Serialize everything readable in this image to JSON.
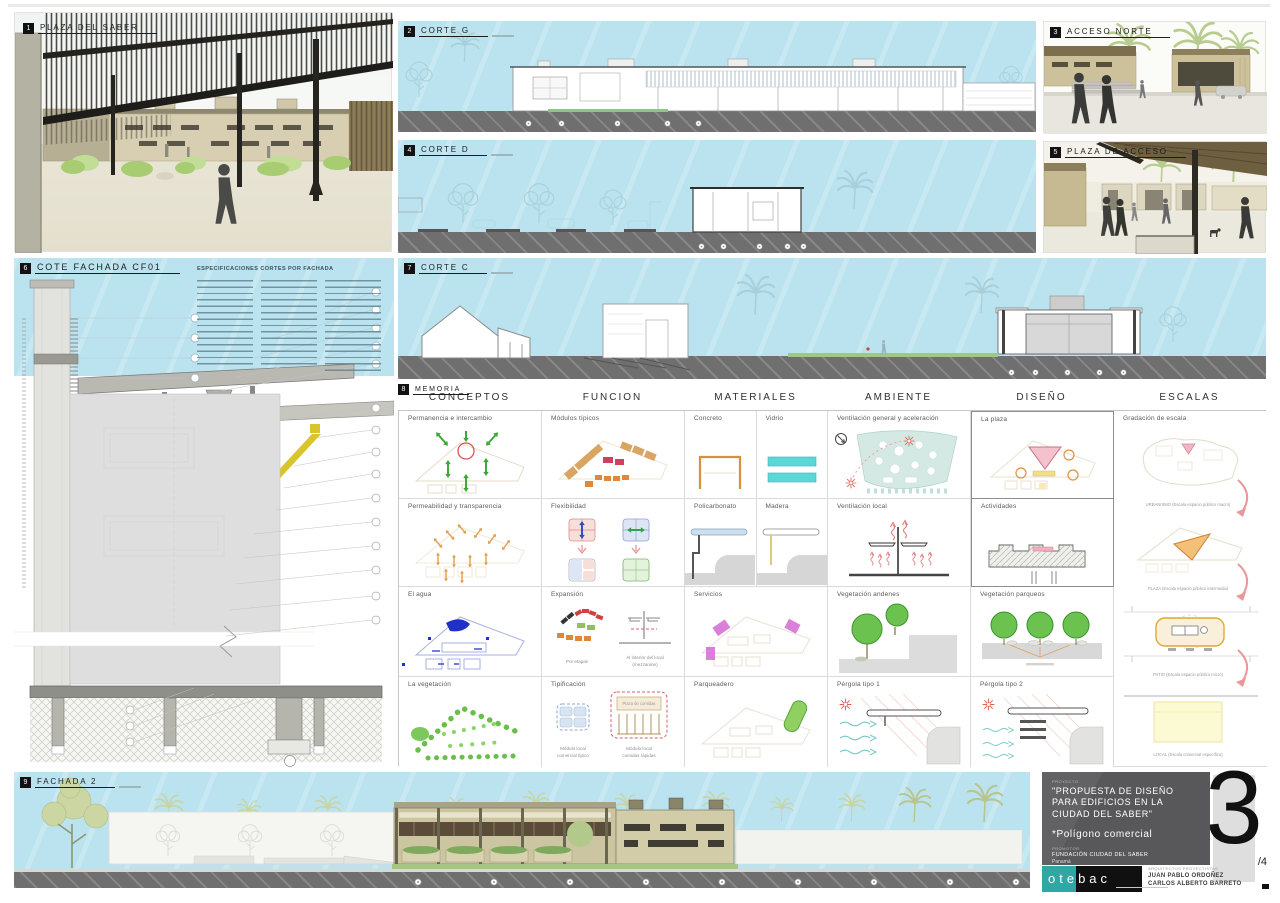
{
  "board": {
    "sheet_number": "3",
    "sheet_total": "/4"
  },
  "panels": {
    "p1": {
      "num": "1",
      "title": "PLAZA DEL SABER"
    },
    "p2": {
      "num": "2",
      "title": "CORTE G"
    },
    "p3": {
      "num": "3",
      "title": "ACCESO NORTE"
    },
    "p4": {
      "num": "4",
      "title": "CORTE D"
    },
    "p5": {
      "num": "5",
      "title": "PLAZA DE ACCESO"
    },
    "p6": {
      "num": "6",
      "title": "COTE FACHADA CF01",
      "specs_title": "ESPECIFICACIONES CORTES POR FACHADA"
    },
    "p7": {
      "num": "7",
      "title": "CORTE C"
    },
    "p8": {
      "num": "8",
      "title": "MEMORIA"
    },
    "p9": {
      "num": "9",
      "title": "FACHADA 2"
    }
  },
  "memoria": {
    "headers": [
      "CONCEPTOS",
      "FUNCION",
      "MATERIALES",
      "AMBIENTE",
      "DISEÑO",
      "ESCALAS"
    ],
    "conceptos": [
      "Permanencia e intercambio",
      "Permeabilidad y transparencia",
      "El agua",
      "La vegetación"
    ],
    "funcion": [
      "Módulos típicos",
      "Flexibilidad",
      "Expansión",
      "Tipificación"
    ],
    "expansion_caps": [
      "Por etapas",
      "Al interior del local",
      "(mezzanine)"
    ],
    "tipificacion_caps": [
      "Módulo local",
      "comercial típico",
      "Módulo local",
      "comidas rápidas"
    ],
    "plaza_comidas": "Plaza de comidas",
    "materiales": [
      "Concreto",
      "Vidrio",
      "Policarbonato",
      "Madera",
      "Servicios",
      "Parqueadero"
    ],
    "ambiente": [
      "Ventilación general y aceleración",
      "Ventilación local",
      "Vegetación andenes",
      "Pérgola tipo 1"
    ],
    "diseno": [
      "La plaza",
      "Actividades",
      "Vegetación parqueos",
      "Pérgola tipo 2"
    ],
    "escalas_title": "Gradación de escala",
    "escalas_caps": [
      "URBANISMO  (Escala espacio público macro)",
      "PLAZA  (Escala espacio público intermedia)",
      "PATIO  (Escala espacio público micro)",
      "LOCAL  (Escala comercial específica)"
    ]
  },
  "titleblock": {
    "project_label": "PROYECTO",
    "project_title": "\"PROPUESTA DE DISEÑO PARA EDIFICIOS EN LA CIUDAD DEL SABER\"",
    "project_subtitle": "*Polígono comercial",
    "client_label": "PROMOTOR",
    "client_name": "FUNDACIÓN CIUDAD DEL SABER",
    "client_location": "Panamá",
    "date": "MAYO DE 2008",
    "logo_text": "otebac",
    "architects_label": "ARQUITECTOS PROYECTISTAS",
    "architect_1": "JUAN PABLO ORDOÑEZ",
    "architect_2": "CARLOS ALBERTO BARRETO"
  }
}
